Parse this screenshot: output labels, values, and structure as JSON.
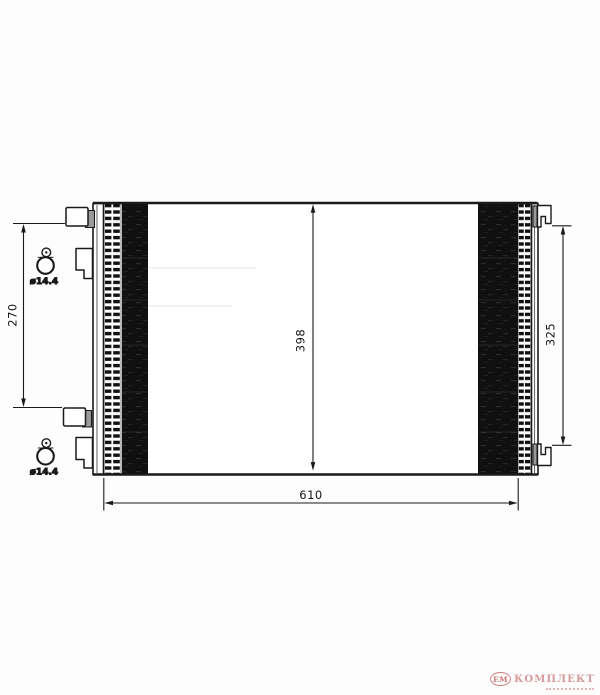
{
  "dimensions": {
    "overall_width": "610",
    "core_height": "398",
    "left_mount_spacing": "270",
    "right_mount_spacing": "325",
    "top_hole_diameter": "ø14.4",
    "bottom_hole_diameter": "ø14.4"
  },
  "watermark": {
    "badge_text": "ЕМ",
    "brand_text": "КОМПЛЕКТ"
  },
  "colors": {
    "line": "#1a1a1a",
    "core_fill": "#101010",
    "bracket_gray": "#9a9a9a",
    "watermark_ring": "#c96a6a",
    "watermark_text": "#d08888"
  }
}
